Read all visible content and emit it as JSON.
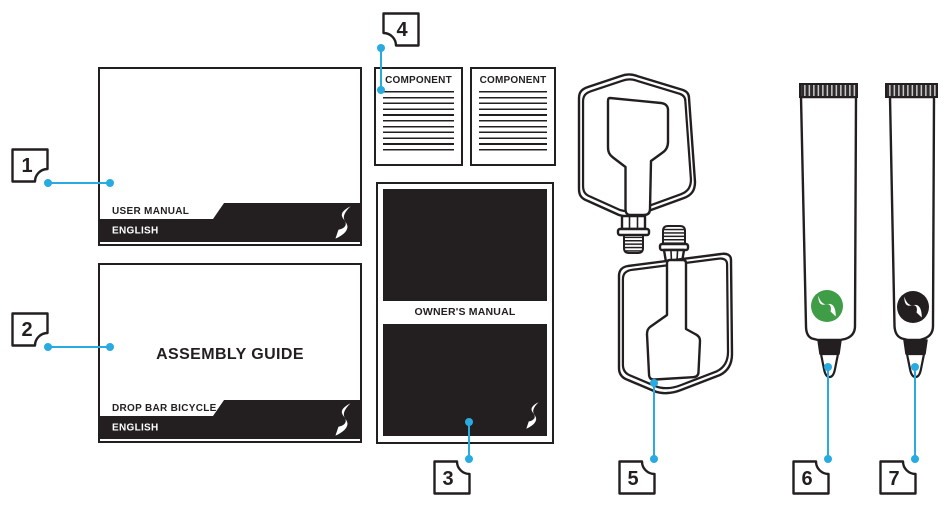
{
  "callouts": [
    {
      "number": "1"
    },
    {
      "number": "2"
    },
    {
      "number": "3"
    },
    {
      "number": "4"
    },
    {
      "number": "5"
    },
    {
      "number": "6"
    },
    {
      "number": "7"
    }
  ],
  "documents": {
    "user_manual": {
      "title": "USER MANUAL",
      "language": "ENGLISH"
    },
    "assembly_guide": {
      "heading": "ASSEMBLY GUIDE",
      "title": "DROP BAR BICYCLE",
      "language": "ENGLISH"
    },
    "component_cards": [
      {
        "title": "COMPONENT"
      },
      {
        "title": "COMPONENT"
      }
    ],
    "owners_manual": {
      "title": "OWNER'S MANUAL"
    }
  },
  "colors": {
    "callout_accent": "#29abe2",
    "ink": "#231f20",
    "logo_green": "#3f9c47",
    "logo_black": "#231f20"
  }
}
